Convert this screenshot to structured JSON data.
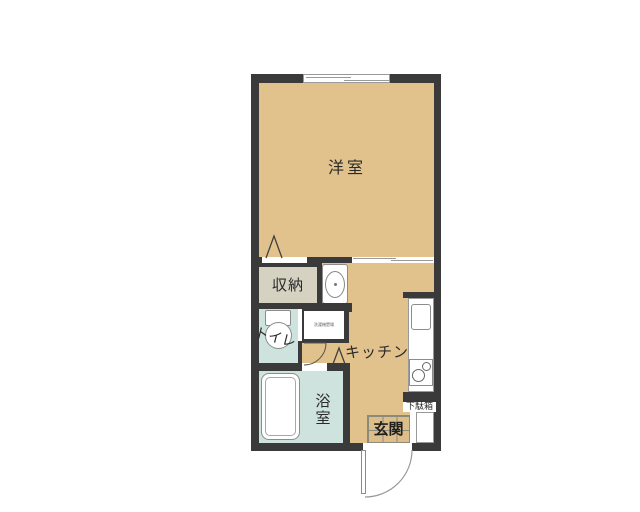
{
  "plan": {
    "labels": {
      "western_room": "洋室",
      "closet": "収納",
      "toilet": "トイレ",
      "kitchen": "キッチン",
      "bathroom": "浴室",
      "entrance": "玄関",
      "shoe_cabinet": "下駄箱",
      "washer_space": "洗濯機置場"
    },
    "colors": {
      "wall": "#3a3a3a",
      "flooring": "#e2c28c",
      "closet_floor": "#d6d2c2",
      "wet_room_floor": "#cfe3de",
      "entrance_tile": "#ddbe8a",
      "fixture_fill": "#ffffff",
      "fixture_outline": "#8c8c8c"
    },
    "icons": {
      "top_wall": "sliding-window",
      "living_partition": "sliding-door",
      "closet_door": "folding-door",
      "bathroom_door": "folding-door",
      "toilet_door": "swing-door-arc",
      "entrance_door": "swing-door-arc",
      "appliances": [
        "washing-machine-pan",
        "toilet-bowl",
        "bathtub",
        "kitchen-sink",
        "two-burner-stove"
      ]
    }
  }
}
